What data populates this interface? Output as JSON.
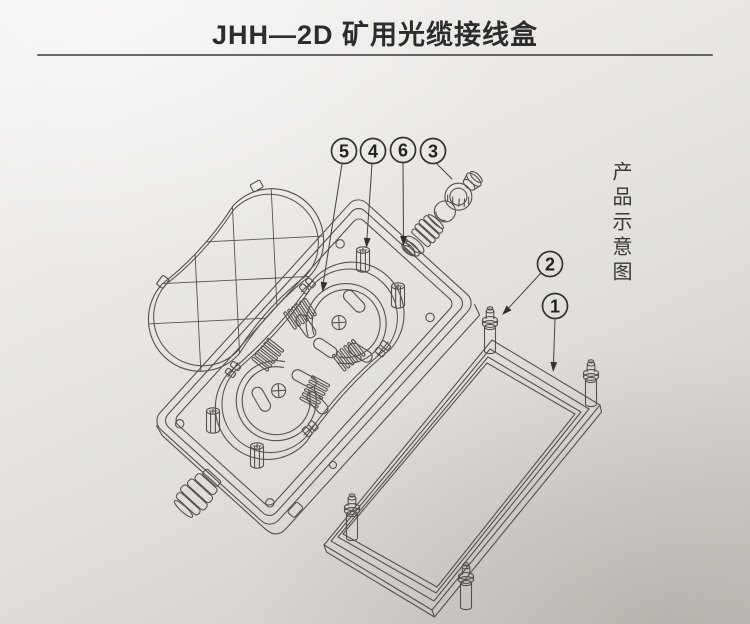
{
  "page": {
    "title": "JHH—2D 矿用光缆接线盒",
    "side_caption": "产品示意图"
  },
  "callouts": [
    {
      "label": "5"
    },
    {
      "label": "4"
    },
    {
      "label": "6"
    },
    {
      "label": "3"
    },
    {
      "label": "2"
    },
    {
      "label": "1"
    }
  ],
  "colors": {
    "paper_highlight": "#f2f0ee",
    "paper_shadow": "#cac7c2",
    "line_ink": "#55524e",
    "title_ink": "#2d2c2a",
    "callout_ink": "#24221f"
  }
}
